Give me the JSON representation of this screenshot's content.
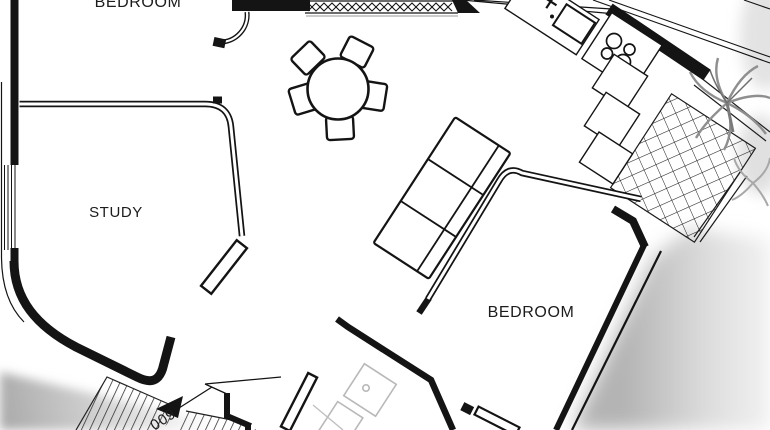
{
  "plan": {
    "rooms": {
      "bedroom_top": {
        "label": "BEDROOM"
      },
      "study": {
        "label": "STUDY"
      },
      "bedroom": {
        "label": "BEDROOM"
      },
      "entry": {
        "number": "009"
      }
    },
    "fixtures": {
      "dining_chairs": 5,
      "cooktop_burners": 4,
      "sofa_sections": 3,
      "items": [
        "dining-table",
        "dining-chairs",
        "sofa",
        "kitchen-sink",
        "kitchen-faucet",
        "kitchen-cooktop",
        "kitchen-cabinets",
        "shower",
        "toilet",
        "balcony-tiles",
        "palm-tree",
        "entrance-arrow",
        "door-swing",
        "window-left",
        "window-top"
      ]
    },
    "colors": {
      "wall_line": "#141414",
      "background": "#ffffff",
      "fixture_grey": "#b8b8b8",
      "shadow_grey": "#bfbfbf",
      "text": "#1c1c1c"
    }
  }
}
